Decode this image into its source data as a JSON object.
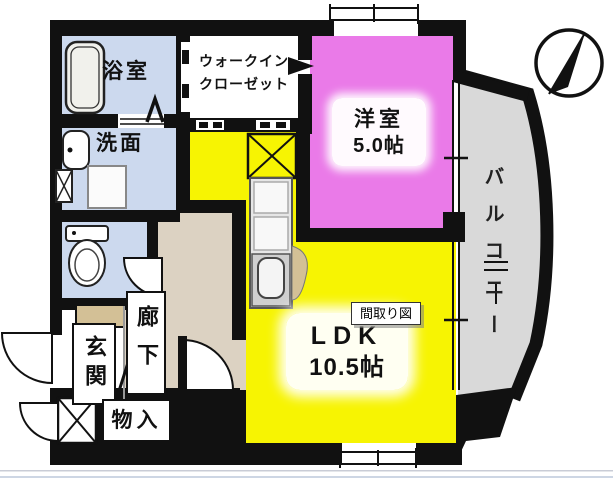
{
  "tooltip": {
    "label": "間取り図"
  },
  "rooms": {
    "bath": {
      "label": "浴室"
    },
    "washroom": {
      "label": "洗面"
    },
    "walk_in_closet": {
      "line1": "ウォークイン",
      "line2": "クローゼット"
    },
    "western": {
      "label": "洋室",
      "size": "5.0帖"
    },
    "ldk": {
      "label": "LDK",
      "size": "10.5帖"
    },
    "balcony": {
      "label": "バルコニー"
    },
    "entrance": {
      "label": "玄関"
    },
    "hallway": {
      "label": "廊下"
    },
    "storage": {
      "label": "物入"
    }
  },
  "colors": {
    "wall": "#111111",
    "wet_rooms": "#ccd9ee",
    "western_room": "#ea7ae8",
    "ldk": "#f7f402",
    "hallway": "#dcd2c2",
    "step_tan": "#d3c096",
    "balcony": "#d9d9d9",
    "background": "#ffffff"
  }
}
